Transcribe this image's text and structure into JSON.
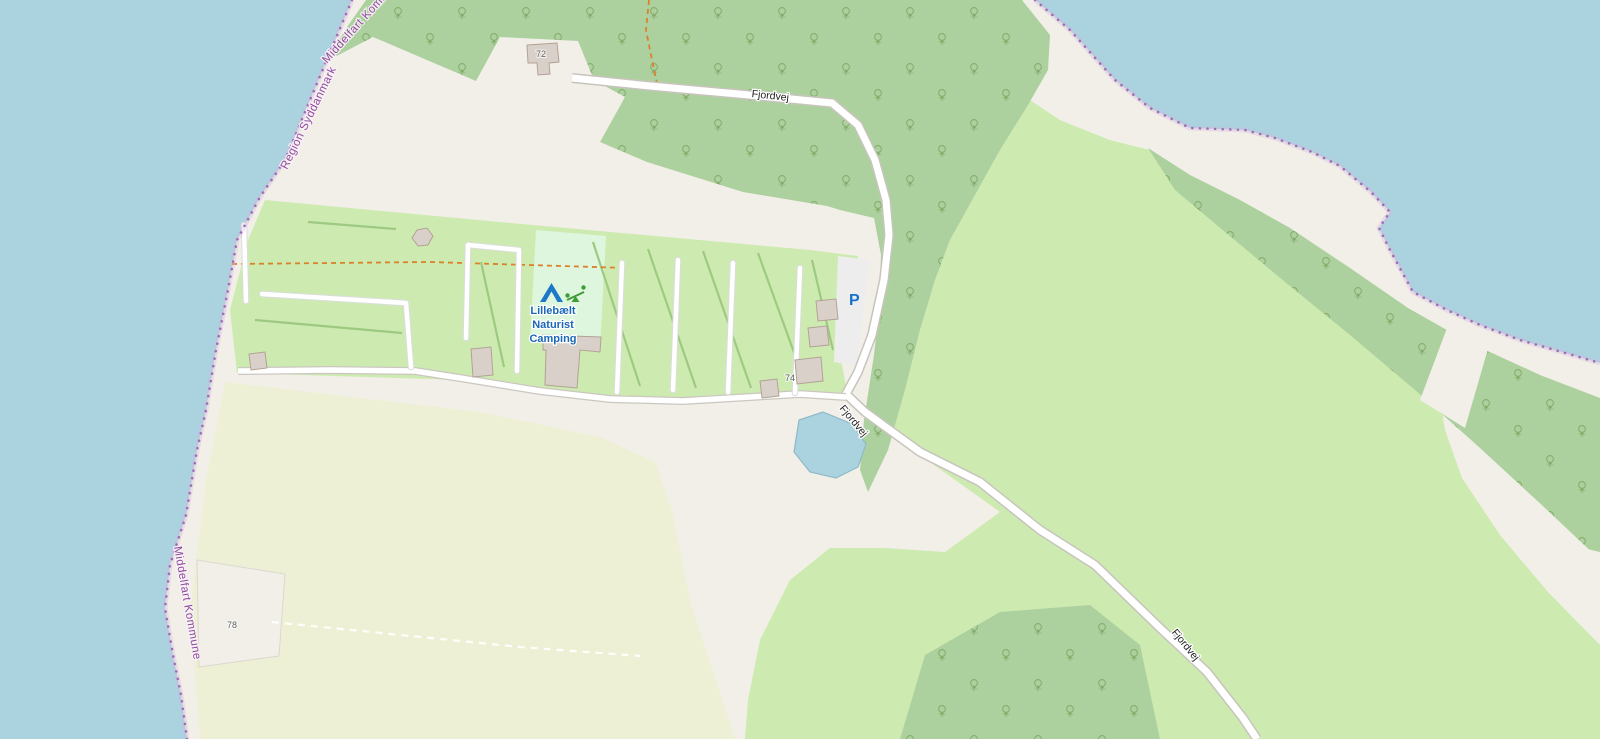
{
  "map": {
    "type": "openstreetmap-slippy-map-view",
    "labels": {
      "road_fjordvej": "Fjordvej",
      "camp_line1": "Lillebælt",
      "camp_line2": "Naturist",
      "camp_line3": "Camping",
      "parking_symbol": "P",
      "house_72": "72",
      "house_74": "74",
      "house_78": "78",
      "boundary_region": "Region Syddanmark",
      "boundary_municipality": "Middelfart Kommune"
    },
    "icons": {
      "tent": "campsite-tent-icon",
      "playground": "playground-icon",
      "parking": "parking-letter-icon",
      "trees": "deciduous-tree-symbols"
    },
    "colors": {
      "water": "#aad3df",
      "land": "#f2efe9",
      "forest": "#add19e",
      "meadow": "#cdebb0",
      "farmland": "#eef0d5",
      "camp_site": "#def6dd",
      "building_fill": "#d9d0c9",
      "building_stroke": "#b3a294",
      "road_fill": "#ffffff",
      "road_casing": "#c8c4bd",
      "path_casing": "#dcdcdc",
      "parking_fill": "#ededed",
      "pond_fill": "#aad3df",
      "pond_stroke": "#8fb9c8",
      "hedge": "#9ec981",
      "tree_symbol": "#79a05c",
      "track_orange": "#d9822b",
      "boundary_purple": "#a06cb8",
      "boundary_halo": "#d5b6dc",
      "boundary_label": "#91499b",
      "camp_label_blue": "#1a66b8",
      "parking_blue": "#1673c9",
      "tent_blue": "#1d78c8",
      "playground_green": "#3e9c36"
    }
  }
}
